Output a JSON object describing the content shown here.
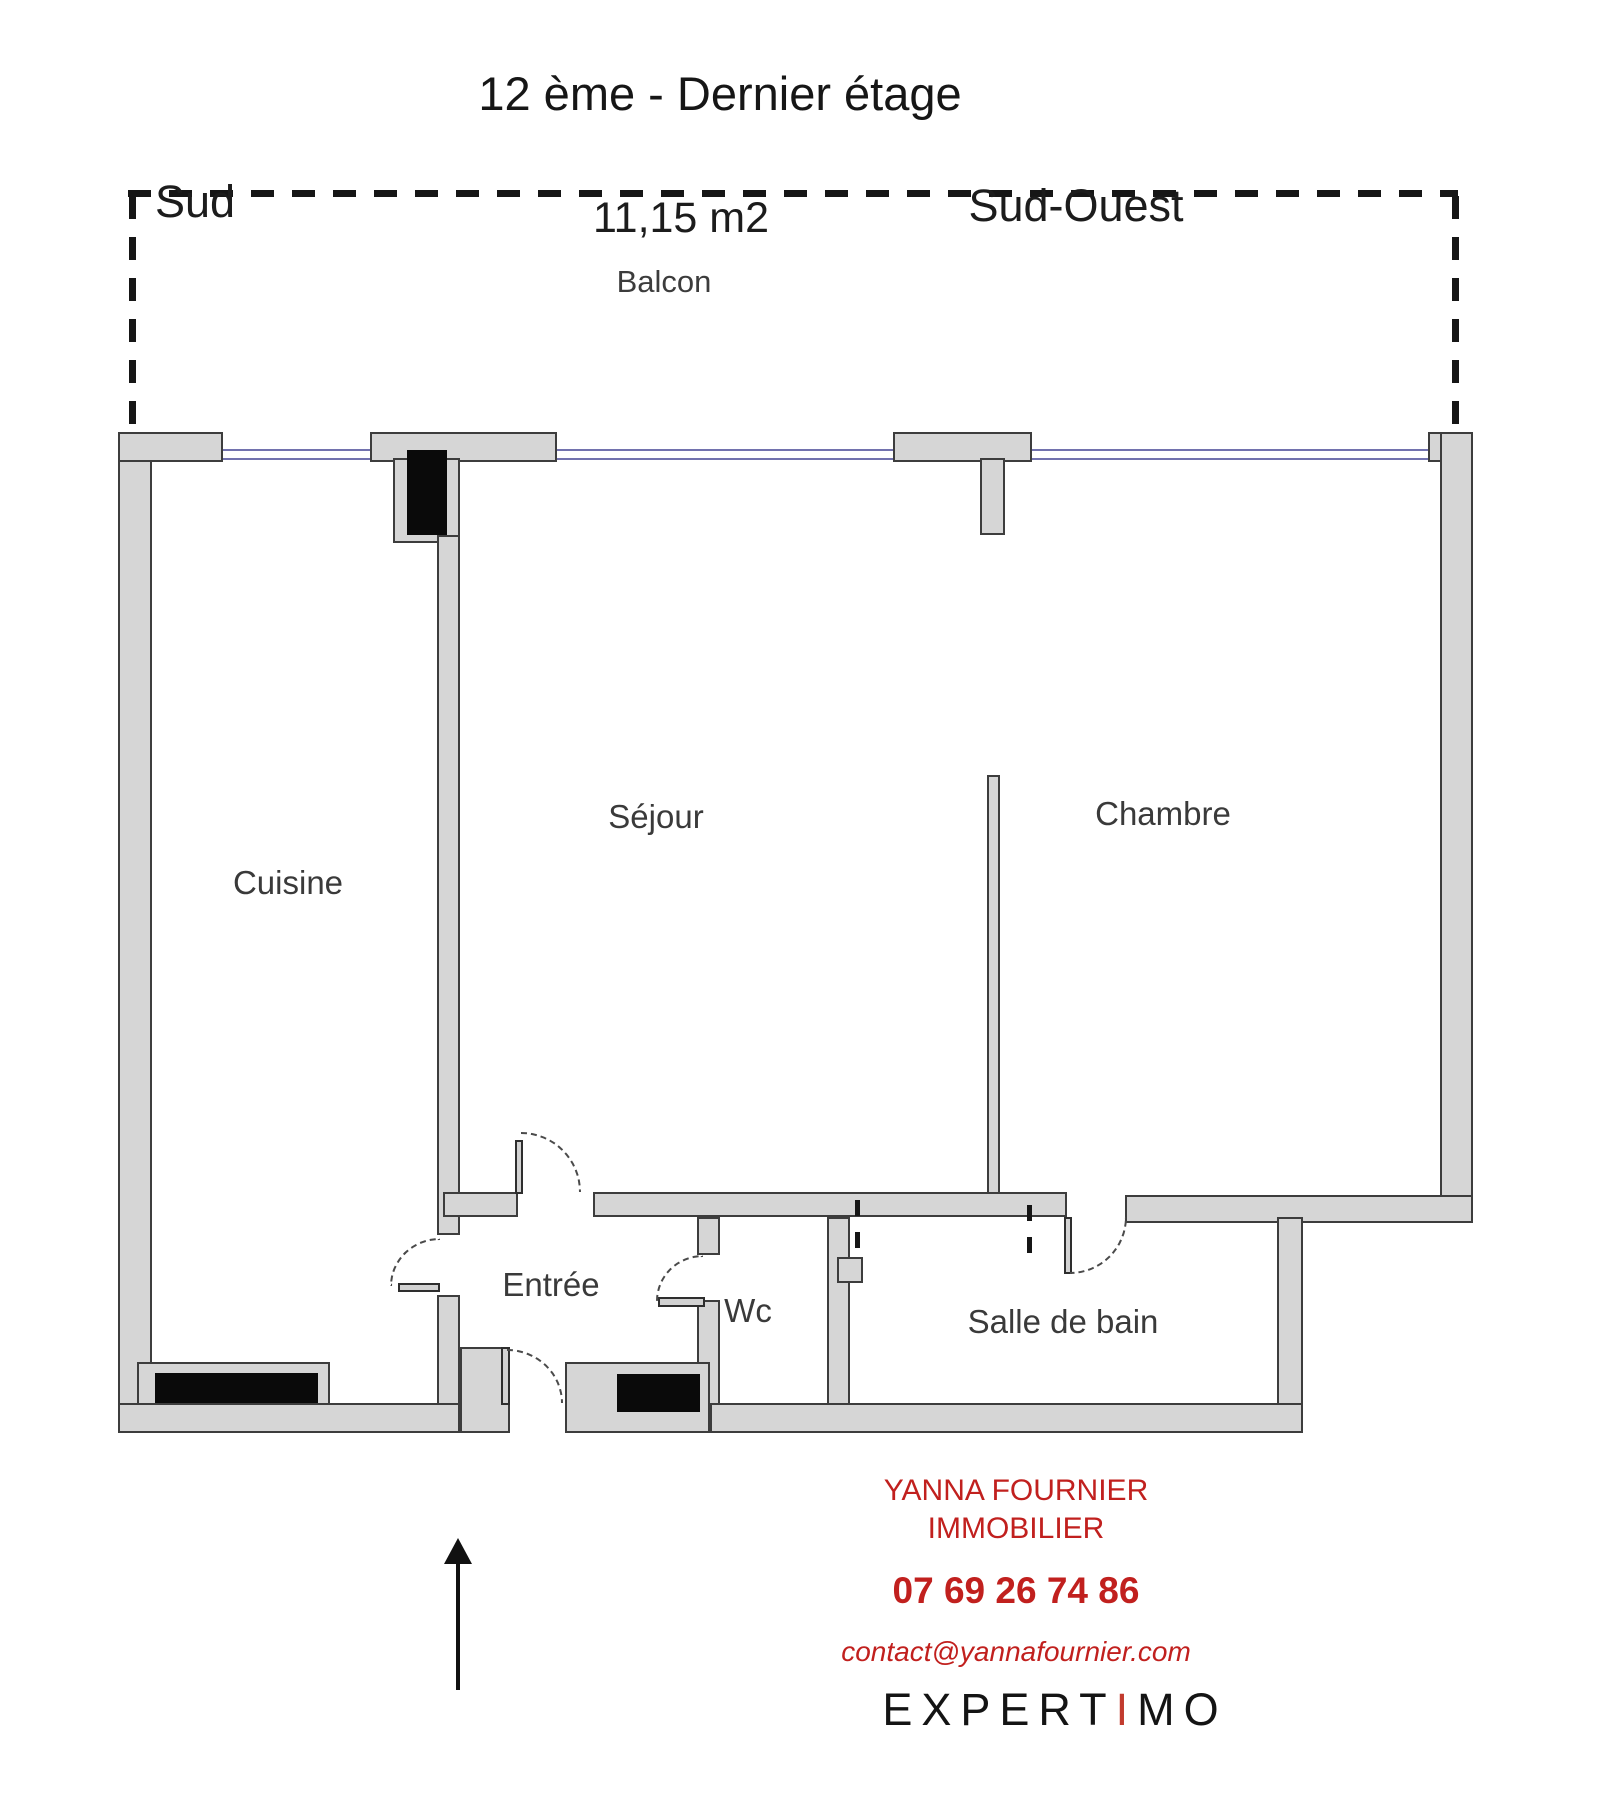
{
  "title": "12 ème - Dernier étage",
  "balcony": {
    "orientation_left": "Sud",
    "area": "11,15 m2",
    "orientation_right": "Sud-Ouest",
    "label": "Balcon"
  },
  "rooms": {
    "kitchen": "Cuisine",
    "living_room": "Séjour",
    "bedroom": "Chambre",
    "entrance": "Entrée",
    "wc": "Wc",
    "bathroom": "Salle de bain"
  },
  "footer": {
    "agency_line1": "YANNA FOURNIER",
    "agency_line2": "IMMOBILIER",
    "phone": "07 69 26 74 86",
    "email": "contact@yannafournier.com",
    "logo": {
      "part1": "EXPERT",
      "accent": "I",
      "part2": "MO"
    }
  },
  "colors": {
    "wall-fill": "#d6d6d6",
    "wall-stroke": "#3d3d3d",
    "window": "#7272ae",
    "accent-red": "#c1201e",
    "logo-accent": "#c23b2e",
    "black": "#0a0a0a"
  }
}
